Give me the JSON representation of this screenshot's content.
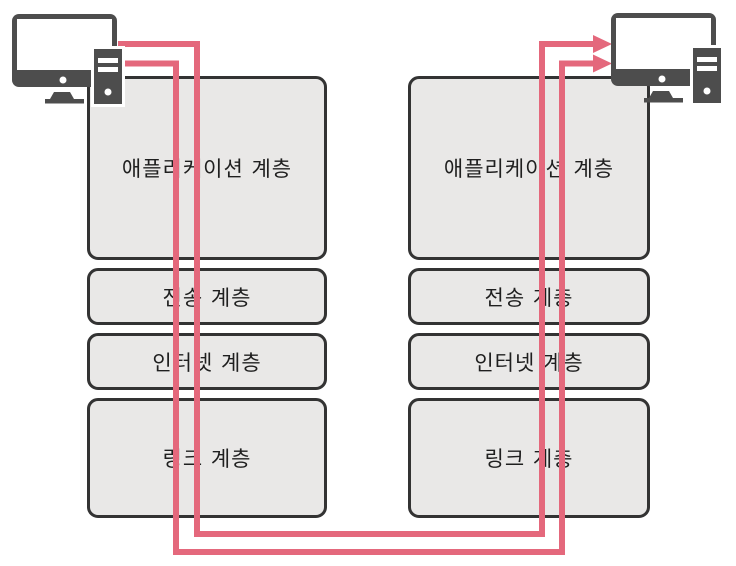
{
  "diagram": {
    "description": "TCP/IP protocol layer stacks between two computers",
    "stacks": [
      {
        "side": "left",
        "layers": [
          "애플리케이션 계층",
          "전송 계층",
          "인터넷 계층",
          "링크 계층"
        ]
      },
      {
        "side": "right",
        "layers": [
          "애플리케이션 계층",
          "전송 계층",
          "인터넷 계층",
          "링크 계층"
        ]
      }
    ],
    "icons": {
      "left": "desktop-computer-icon",
      "right": "desktop-computer-icon"
    },
    "arrows": [
      {
        "name": "flow-arrow-upper",
        "direction": "left-computer to right-computer"
      },
      {
        "name": "flow-arrow-lower",
        "direction": "left-computer to right-computer"
      }
    ],
    "colors": {
      "arrow_pink": "#e4687c",
      "box_fill": "#e9e8e7",
      "box_border": "#333333",
      "icon_gray": "#4d4d4d",
      "background": "#ffffff"
    }
  }
}
